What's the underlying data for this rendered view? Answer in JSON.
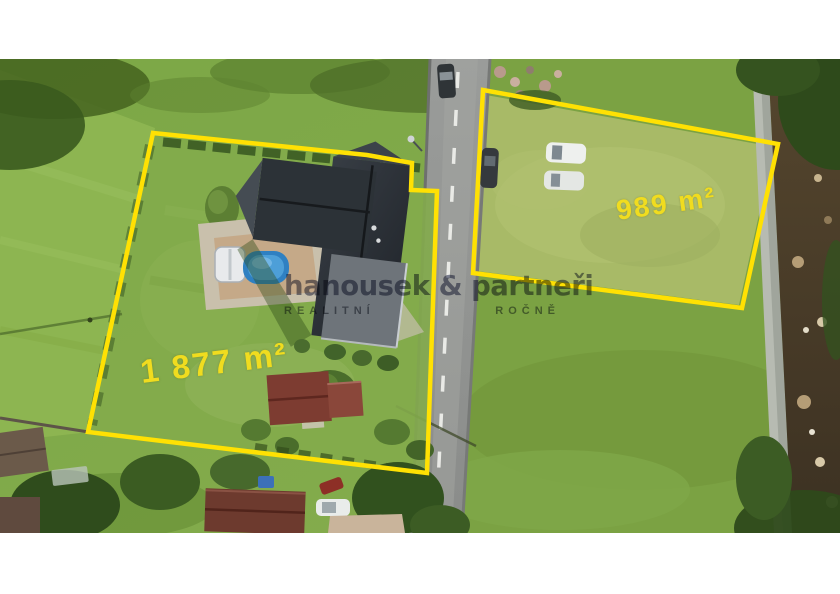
{
  "annotations": {
    "left_plot": {
      "area_label": "1 877 m²"
    },
    "right_plot": {
      "area_label": "989 m²"
    }
  },
  "watermark": {
    "title": "hanousek & partneři",
    "subtitle_left": "REALITNÍ",
    "subtitle_right": "ROČNĚ"
  },
  "colors": {
    "boundary": "#ffe103",
    "area_label": "#f0dc1f",
    "watermark_title": "#3d4263",
    "watermark_subtitle": "#59606e",
    "road": "#8f918f",
    "grass": "#7aa544",
    "mowed_grass": "#a8ba67",
    "roof_dark": "#2b3036",
    "roof_red": "#7d3c31",
    "pool": "#2f80c2",
    "stream": "#4a3b28",
    "letterbox": "#ffffff"
  }
}
